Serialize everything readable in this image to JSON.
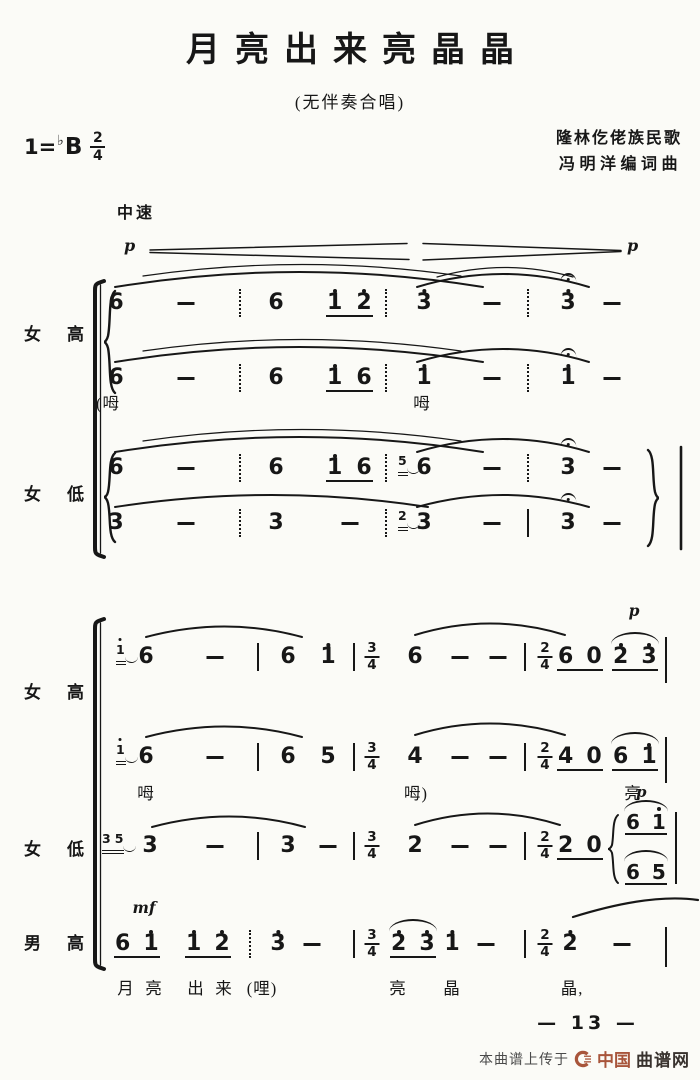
{
  "page": {
    "bg": "#fbfbf7",
    "ink": "#171717"
  },
  "header": {
    "title": "月亮出来亮晶晶",
    "subtitle": "(无伴奏合唱)",
    "key": {
      "prefix": "1=",
      "flat": "♭",
      "tonic": "B",
      "meter_num": "2",
      "meter_den": "4"
    },
    "credits": [
      "隆林仡佬族民歌",
      "冯明洋编词曲"
    ]
  },
  "tempo": "中速",
  "dynamics": {
    "start": "p",
    "end": "p"
  },
  "system1": {
    "labels": {
      "soprano": "女高",
      "alto": "女低"
    },
    "voices": {
      "soprano1": [
        {
          "type": "note",
          "x": 116,
          "t": "6"
        },
        {
          "type": "dash",
          "x": 186
        },
        {
          "type": "bar",
          "x": 240,
          "style": "dotted"
        },
        {
          "type": "note",
          "x": 276,
          "t": "6"
        },
        {
          "type": "group",
          "x": 327,
          "gap": 14,
          "ul": 1,
          "notes": [
            {
              "t": "1",
              "hi": 1
            },
            {
              "t": "2",
              "hi": 1
            }
          ]
        },
        {
          "type": "bar",
          "x": 386,
          "style": "dotted"
        },
        {
          "type": "note",
          "x": 424,
          "t": "3",
          "hi": 1
        },
        {
          "type": "dash",
          "x": 492
        },
        {
          "type": "bar",
          "x": 528,
          "style": "dotted"
        },
        {
          "type": "note",
          "x": 568,
          "t": "3",
          "hi": 1,
          "fer": 1
        },
        {
          "type": "dash",
          "x": 612
        }
      ],
      "soprano2": [
        {
          "type": "note",
          "x": 116,
          "t": "6"
        },
        {
          "type": "dash",
          "x": 186
        },
        {
          "type": "bar",
          "x": 240,
          "style": "dotted"
        },
        {
          "type": "note",
          "x": 276,
          "t": "6"
        },
        {
          "type": "group",
          "x": 327,
          "gap": 14,
          "ul": 1,
          "notes": [
            {
              "t": "1",
              "hi": 1
            },
            {
              "t": "6"
            }
          ]
        },
        {
          "type": "bar",
          "x": 386,
          "style": "dotted"
        },
        {
          "type": "note",
          "x": 424,
          "t": "1",
          "hi": 1
        },
        {
          "type": "dash",
          "x": 492
        },
        {
          "type": "bar",
          "x": 528,
          "style": "dotted"
        },
        {
          "type": "note",
          "x": 568,
          "t": "1",
          "hi": 1,
          "fer": 1
        },
        {
          "type": "dash",
          "x": 612
        }
      ],
      "alto1": [
        {
          "type": "note",
          "x": 116,
          "t": "6"
        },
        {
          "type": "dash",
          "x": 186
        },
        {
          "type": "bar",
          "x": 240,
          "style": "dotted"
        },
        {
          "type": "note",
          "x": 276,
          "t": "6"
        },
        {
          "type": "group",
          "x": 327,
          "gap": 14,
          "ul": 1,
          "notes": [
            {
              "t": "1",
              "hi": 1
            },
            {
              "t": "6"
            }
          ]
        },
        {
          "type": "bar",
          "x": 386,
          "style": "dotted"
        },
        {
          "type": "grace",
          "x": 398,
          "notes": [
            {
              "t": "5"
            }
          ]
        },
        {
          "type": "note",
          "x": 424,
          "t": "6"
        },
        {
          "type": "dash",
          "x": 492
        },
        {
          "type": "bar",
          "x": 528,
          "style": "dotted"
        },
        {
          "type": "note",
          "x": 568,
          "t": "3",
          "fer": 1
        },
        {
          "type": "dash",
          "x": 612
        }
      ],
      "alto2": [
        {
          "type": "note",
          "x": 116,
          "t": "3"
        },
        {
          "type": "dash",
          "x": 186
        },
        {
          "type": "bar",
          "x": 240,
          "style": "dotted"
        },
        {
          "type": "note",
          "x": 276,
          "t": "3"
        },
        {
          "type": "dash",
          "x": 350
        },
        {
          "type": "bar",
          "x": 386,
          "style": "dotted"
        },
        {
          "type": "grace",
          "x": 398,
          "notes": [
            {
              "t": "2"
            }
          ]
        },
        {
          "type": "note",
          "x": 424,
          "t": "3"
        },
        {
          "type": "dash",
          "x": 492
        },
        {
          "type": "bar",
          "x": 528
        },
        {
          "type": "note",
          "x": 568,
          "t": "3",
          "fer": 1
        },
        {
          "type": "dash",
          "x": 612
        }
      ]
    },
    "lyrics": [
      {
        "type": "text",
        "x": 108,
        "t": "(呣"
      },
      {
        "type": "text",
        "x": 422,
        "t": "呣"
      }
    ]
  },
  "system2": {
    "labels": {
      "soprano": "女高",
      "alto": "女低",
      "tenor": "男高"
    },
    "voices": {
      "soprano1": [
        {
          "type": "grace",
          "x": 116,
          "notes": [
            {
              "t": "1",
              "hi": 1
            }
          ]
        },
        {
          "type": "note",
          "x": 146,
          "t": "6"
        },
        {
          "type": "dash",
          "x": 215
        },
        {
          "type": "bar",
          "x": 258
        },
        {
          "type": "note",
          "x": 288,
          "t": "6"
        },
        {
          "type": "note",
          "x": 328,
          "t": "1",
          "hi": 1
        },
        {
          "type": "bar",
          "x": 354
        },
        {
          "type": "ts",
          "x": 372,
          "num": "3",
          "den": "4"
        },
        {
          "type": "note",
          "x": 415,
          "t": "6"
        },
        {
          "type": "dash",
          "x": 460
        },
        {
          "type": "dash",
          "x": 498
        },
        {
          "type": "bar",
          "x": 525
        },
        {
          "type": "ts",
          "x": 545,
          "num": "2",
          "den": "4"
        },
        {
          "type": "group",
          "x": 558,
          "gap": 13,
          "ul": 1,
          "notes": [
            {
              "t": "6"
            },
            {
              "t": "0"
            }
          ]
        },
        {
          "type": "dyn",
          "x": 634,
          "dy": -46,
          "t": "p"
        },
        {
          "type": "group",
          "x": 613,
          "gap": 13,
          "ul": 1,
          "slur": 1,
          "notes": [
            {
              "t": "2",
              "hi": 1
            },
            {
              "t": "3",
              "hi": 1
            }
          ]
        },
        {
          "type": "bar",
          "x": 666,
          "h": 46,
          "dy": -6
        }
      ],
      "soprano2": [
        {
          "type": "grace",
          "x": 116,
          "notes": [
            {
              "t": "1",
              "hi": 1
            }
          ]
        },
        {
          "type": "note",
          "x": 146,
          "t": "6"
        },
        {
          "type": "dash",
          "x": 215
        },
        {
          "type": "bar",
          "x": 258
        },
        {
          "type": "note",
          "x": 288,
          "t": "6"
        },
        {
          "type": "note",
          "x": 328,
          "t": "5"
        },
        {
          "type": "bar",
          "x": 354
        },
        {
          "type": "ts",
          "x": 372,
          "num": "3",
          "den": "4"
        },
        {
          "type": "note",
          "x": 415,
          "t": "4"
        },
        {
          "type": "dash",
          "x": 460
        },
        {
          "type": "dash",
          "x": 498
        },
        {
          "type": "bar",
          "x": 525
        },
        {
          "type": "ts",
          "x": 545,
          "num": "2",
          "den": "4"
        },
        {
          "type": "group",
          "x": 558,
          "gap": 13,
          "ul": 1,
          "notes": [
            {
              "t": "4"
            },
            {
              "t": "0"
            }
          ]
        },
        {
          "type": "group",
          "x": 613,
          "gap": 13,
          "ul": 1,
          "slur": 1,
          "notes": [
            {
              "t": "6"
            },
            {
              "t": "1",
              "hi": 1
            }
          ]
        },
        {
          "type": "bar",
          "x": 666,
          "h": 46,
          "dy": -6
        }
      ],
      "alto": [
        {
          "type": "grace",
          "x": 102,
          "notes": [
            {
              "t": "3"
            },
            {
              "t": "5"
            }
          ]
        },
        {
          "type": "note",
          "x": 150,
          "t": "3"
        },
        {
          "type": "dash",
          "x": 215
        },
        {
          "type": "bar",
          "x": 258
        },
        {
          "type": "note",
          "x": 288,
          "t": "3"
        },
        {
          "type": "dash",
          "x": 328
        },
        {
          "type": "bar",
          "x": 354
        },
        {
          "type": "ts",
          "x": 372,
          "num": "3",
          "den": "4"
        },
        {
          "type": "note",
          "x": 415,
          "t": "2"
        },
        {
          "type": "dash",
          "x": 460
        },
        {
          "type": "dash",
          "x": 498
        },
        {
          "type": "bar",
          "x": 525
        },
        {
          "type": "ts",
          "x": 545,
          "num": "2",
          "den": "4"
        },
        {
          "type": "group",
          "x": 558,
          "gap": 13,
          "ul": 1,
          "notes": [
            {
              "t": "2"
            },
            {
              "t": "0"
            }
          ]
        },
        {
          "type": "divisi",
          "x": 606,
          "top": {
            "p": "p",
            "slur": 1,
            "notes": [
              {
                "t": "6"
              },
              {
                "t": "1",
                "hi": 1
              }
            ]
          },
          "bottom": {
            "slur": 1,
            "notes": [
              {
                "t": "6"
              },
              {
                "t": "5"
              }
            ]
          }
        },
        {
          "type": "bar",
          "x": 676,
          "h": 72,
          "dy": -20
        }
      ],
      "tenor": [
        {
          "type": "dyn",
          "x": 144,
          "dy": -36,
          "t": "mf"
        },
        {
          "type": "group",
          "x": 115,
          "gap": 13,
          "ul": 1,
          "notes": [
            {
              "t": "6"
            },
            {
              "t": "1",
              "hi": 1
            }
          ]
        },
        {
          "type": "group",
          "x": 186,
          "gap": 13,
          "ul": 1,
          "notes": [
            {
              "t": "1",
              "hi": 1
            },
            {
              "t": "2",
              "hi": 1
            }
          ]
        },
        {
          "type": "bar",
          "x": 250,
          "style": "dotted"
        },
        {
          "type": "note",
          "x": 278,
          "t": "3",
          "hi": 1
        },
        {
          "type": "dash",
          "x": 312
        },
        {
          "type": "bar",
          "x": 354
        },
        {
          "type": "ts",
          "x": 372,
          "num": "3",
          "den": "4"
        },
        {
          "type": "group",
          "x": 391,
          "gap": 13,
          "ul": 1,
          "slur": 1,
          "notes": [
            {
              "t": "2",
              "hi": 1
            },
            {
              "t": "3",
              "hi": 1
            }
          ]
        },
        {
          "type": "note",
          "x": 452,
          "t": "1",
          "hi": 1
        },
        {
          "type": "dash",
          "x": 486
        },
        {
          "type": "bar",
          "x": 525
        },
        {
          "type": "ts",
          "x": 545,
          "num": "2",
          "den": "4"
        },
        {
          "type": "note",
          "x": 570,
          "t": "2",
          "hi": 1
        },
        {
          "type": "dash",
          "x": 622
        },
        {
          "type": "bar",
          "x": 666,
          "h": 40,
          "dy": -3
        }
      ]
    },
    "lyrics_upper": [
      {
        "type": "text",
        "x": 146,
        "t": "呣"
      },
      {
        "type": "text",
        "x": 416,
        "t": "呣)"
      },
      {
        "type": "text",
        "x": 633,
        "t": "亮"
      }
    ],
    "lyrics_tenor": [
      {
        "type": "text",
        "x": 126,
        "t": "月"
      },
      {
        "type": "text",
        "x": 154,
        "t": "亮"
      },
      {
        "type": "text",
        "x": 196,
        "t": "出"
      },
      {
        "type": "text",
        "x": 224,
        "t": "来"
      },
      {
        "type": "text",
        "x": 262,
        "t": "(哩)"
      },
      {
        "type": "text",
        "x": 398,
        "t": "亮"
      },
      {
        "type": "text",
        "x": 452,
        "t": "晶"
      },
      {
        "type": "text",
        "x": 572,
        "t": "晶,"
      }
    ]
  },
  "footer": {
    "page_number": "— 13 —",
    "watermark": {
      "prefix": "本曲谱上传于",
      "brand_strong": "中国",
      "brand": "曲谱网",
      "brand_color": "#a8553b"
    }
  }
}
